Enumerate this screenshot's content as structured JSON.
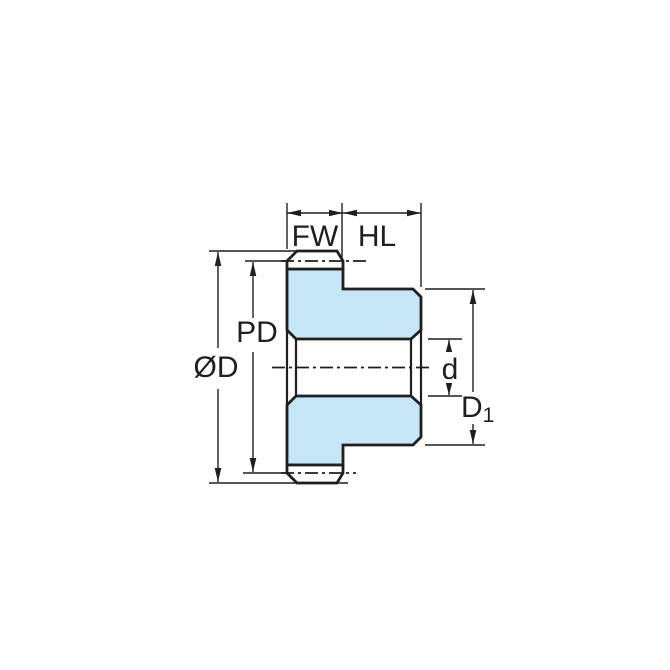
{
  "diagram": {
    "kind": "gear-cross-section-dimension-drawing",
    "labels": {
      "face_width": "FW",
      "hub_length": "HL",
      "pitch_diameter": "PD",
      "outside_diameter": "ØD",
      "bore_diameter": "d",
      "hub_diameter_main": "D",
      "hub_diameter_sub": "1"
    },
    "colors": {
      "background": "#ffffff",
      "line": "#1f1f1f",
      "part_fill": "#c5e6f7"
    }
  }
}
